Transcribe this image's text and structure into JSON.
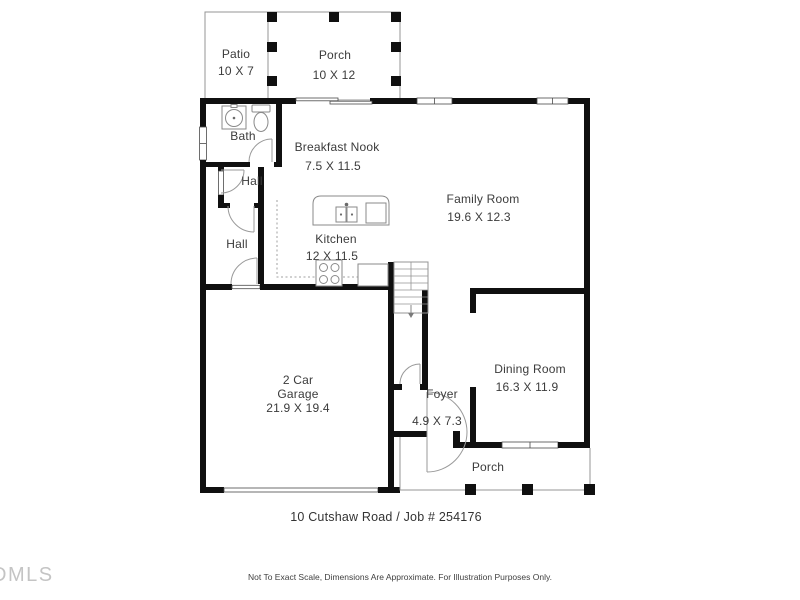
{
  "plan": {
    "rooms": [
      {
        "id": "patio",
        "name": "Patio",
        "dims": "10 X 7"
      },
      {
        "id": "porch-top",
        "name": "Porch",
        "dims": "10 X 12"
      },
      {
        "id": "bath",
        "name": "Bath"
      },
      {
        "id": "breakfast-nook",
        "name": "Breakfast Nook",
        "dims": "7.5 X 11.5"
      },
      {
        "id": "hall-upper",
        "name": "Hall"
      },
      {
        "id": "hall-lower",
        "name": "Hall"
      },
      {
        "id": "kitchen",
        "name": "Kitchen",
        "dims": "12 X 11.5"
      },
      {
        "id": "family-room",
        "name": "Family Room",
        "dims": "19.6 X 12.3"
      },
      {
        "id": "garage",
        "line1": "2 Car",
        "line2": "Garage",
        "dims": "21.9 X 19.4"
      },
      {
        "id": "dining-room",
        "name": "Dining Room",
        "dims": "16.3 X 11.9"
      },
      {
        "id": "foyer",
        "name": "Foyer",
        "dims": "4.9 X 7.3"
      },
      {
        "id": "porch-bottom",
        "name": "Porch"
      }
    ],
    "footer": {
      "address_job": "10 Cutshaw Road / Job # 254176",
      "disclaimer": "Not To Exact Scale, Dimensions Are Approximate. For Illustration Purposes Only.",
      "watermark": "DMLS"
    },
    "icons": [
      "bath-sink-icon",
      "toilet-icon",
      "kitchen-island",
      "island-sink-icon",
      "stove-icon",
      "stairs",
      "door-arc",
      "window",
      "porch-post",
      "garage-door"
    ],
    "colors": {
      "wall": "#101010",
      "thin_line": "#949494",
      "text": "#3b3b3b",
      "watermark": "#c4c4c4",
      "background": "#ffffff"
    }
  }
}
